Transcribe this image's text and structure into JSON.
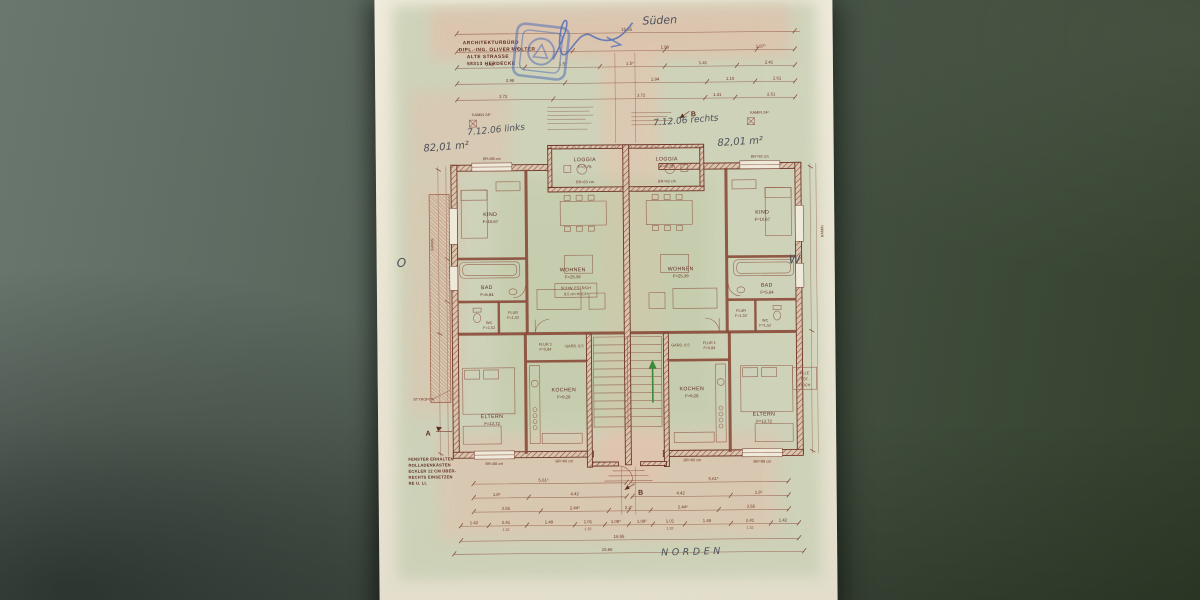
{
  "handwritten": {
    "sueden": "Süden",
    "norden": "NORDEN",
    "ost": "O",
    "west": "W",
    "date_left": "7.12.06 links",
    "area_left": "82,01 m²",
    "date_right": "7.12.06 rechts",
    "area_right": "82,01 m²"
  },
  "architect": {
    "line1": "ARCHITEKTURBÜRO",
    "line2": "DIPL.-ING. OLIVER WOLTER",
    "line3": "ALTE STRASSE",
    "line4": "58313 HERDECKE"
  },
  "rooms": {
    "kind": {
      "name": "KIND",
      "area": "F=10,67"
    },
    "wohnen": {
      "name": "WOHNEN",
      "area": "F=25,39"
    },
    "loggia": {
      "name": "LOGGIA",
      "area": "F=3,75"
    },
    "bad": {
      "name": "BAD",
      "area": "F=5,64"
    },
    "wc": {
      "name": "WC",
      "area": "F=1,52"
    },
    "flur": {
      "name": "FLUR",
      "area": "F=1,52"
    },
    "flur1": {
      "name": "FLUR 1",
      "area": "F=5,84"
    },
    "kochen": {
      "name": "KOCHEN",
      "area": "F=9,28"
    },
    "eltern": {
      "name": "ELTERN",
      "area": "F=13,72"
    }
  },
  "fixtures": {
    "br88": "BR=88 cm",
    "br63": "BR=63 cm",
    "br92": "BR=92 cm",
    "br66": "BR=66 cm",
    "kamin24": "KAMIN 24²",
    "kamin_side": "KAMIN",
    "styropor": "STYROPOR",
    "schwelle_l1": "SCHW. ESTRICH",
    "schwelle_l2": "8,5 cm HOCH",
    "gard": "GARD. 0,5"
  },
  "sections": {
    "a": "A",
    "b": "B"
  },
  "notes": {
    "window_l1": "FENSTER ERHALTEN",
    "window_l2": "ROLLADENKÄSTEN",
    "window_l3": "ECKLER 12 CM ÜBER-",
    "window_l4": "RECHTS EINSETZEN",
    "window_l5": "RE U. LI.",
    "side_l1": "ALLE",
    "side_l2": "EST.",
    "side_l3": "HOCH"
  },
  "dims": {
    "top_total": "15.55",
    "t1a": "3.98",
    "t1b": "1.98",
    "t1c": "1.87⁵",
    "t2a": "2.58",
    "t2b": "1.5⁵",
    "t2c": "1.5⁵",
    "t2d": "1.41",
    "t2e": "2.41",
    "t3a": "2.98",
    "t3b": "1.94",
    "t3c": "1.10",
    "t3d": "2.61",
    "t4a": "3.72",
    "t4b": "3.72",
    "t4c": "1.41",
    "t4d": "2.61",
    "b1a": "5.61⁵",
    "b1b": "5.61⁵",
    "b2a": "1.8⁵",
    "b2b": "4.42",
    "b2c": "4.42",
    "b2d": "1.8⁵",
    "b3a": "3.55",
    "b3b": "2.44⁵",
    "b3c": "2.2⁵",
    "b3d": "2.44⁵",
    "b3e": "3.55",
    "b4a": "1.42",
    "b4b": "2.41",
    "b4c": "1.49",
    "b4d": "1.01",
    "b4e": "1.08⁵",
    "b4f": "1.08⁵",
    "b4g": "1.01",
    "b4h": "1.49",
    "b4i": "2.41",
    "b4j": "1.42",
    "b4s": "1.32",
    "bottom_total1": "16.55",
    "bottom_total2": "15.66"
  }
}
